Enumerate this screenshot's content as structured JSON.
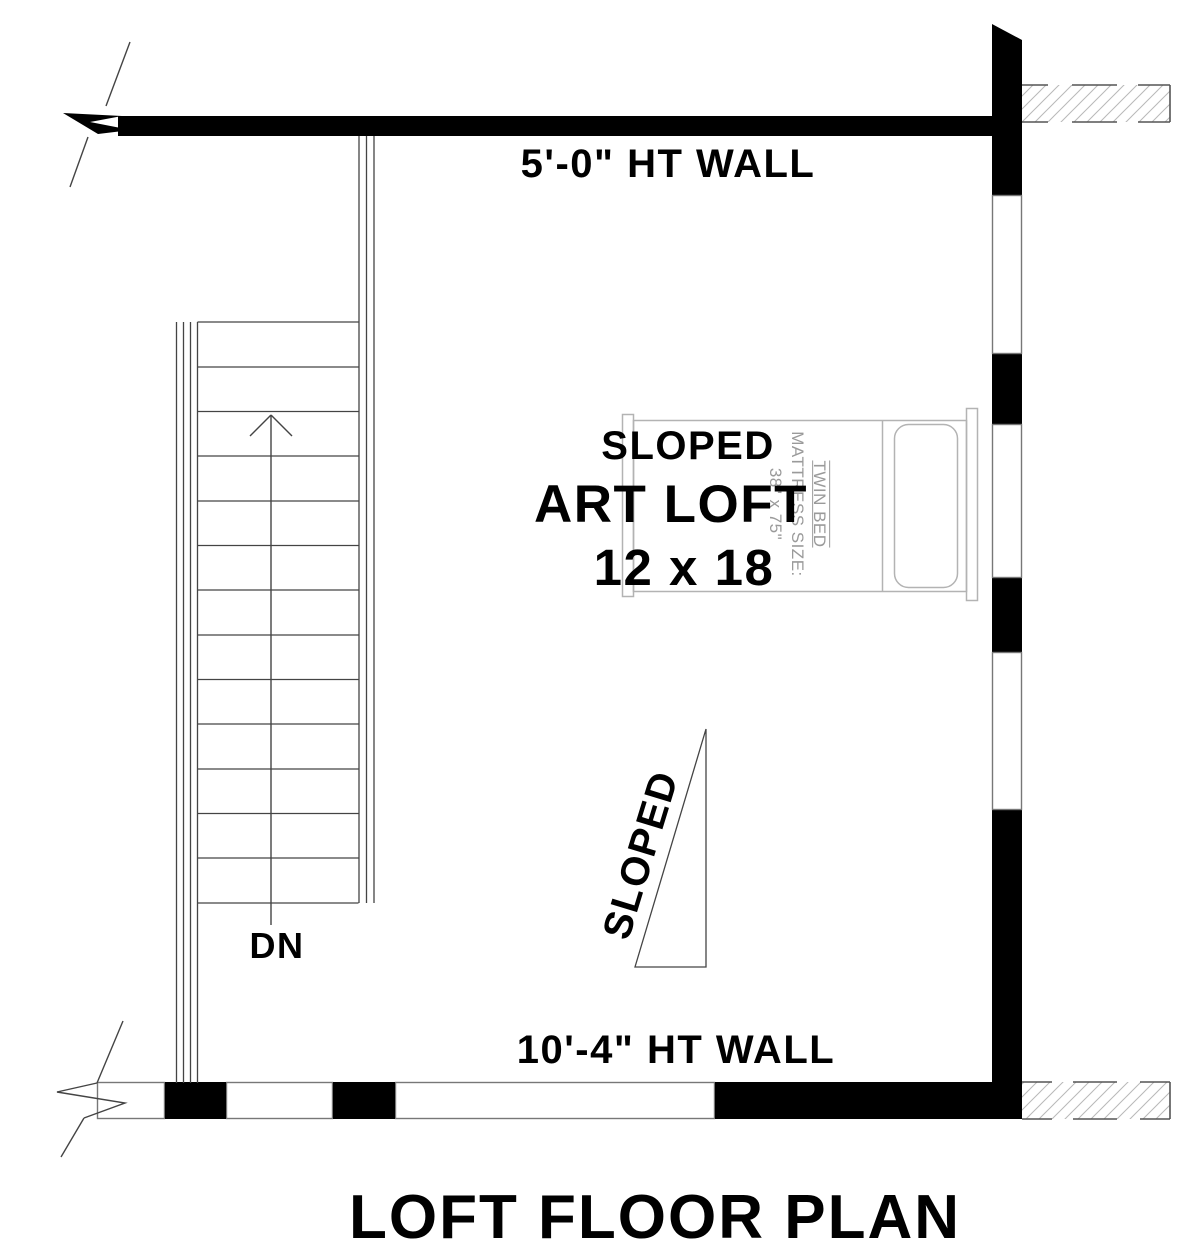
{
  "plan_title": "LOFT FLOOR PLAN",
  "walls": {
    "top_label": "5'-0\" HT WALL",
    "bottom_label": "10'-4\" HT WALL"
  },
  "room": {
    "line1": "SLOPED",
    "line2": "ART LOFT",
    "line3": "12 x 18"
  },
  "annotations": {
    "sloped_ceiling": "SLOPED",
    "stair_direction": "DN"
  },
  "bed": {
    "line1": "TWIN BED",
    "line2": "MATTRESS SIZE:",
    "line3": "38\" x 75\""
  },
  "colors": {
    "ink": "#000000",
    "thin_line": "#444444",
    "wall_segment_border": "#777777",
    "bed_line": "#b3b3b3",
    "bed_text": "#9a9a9a",
    "hatch_line": "#b8b8b8",
    "hatch_border": "#555555"
  }
}
